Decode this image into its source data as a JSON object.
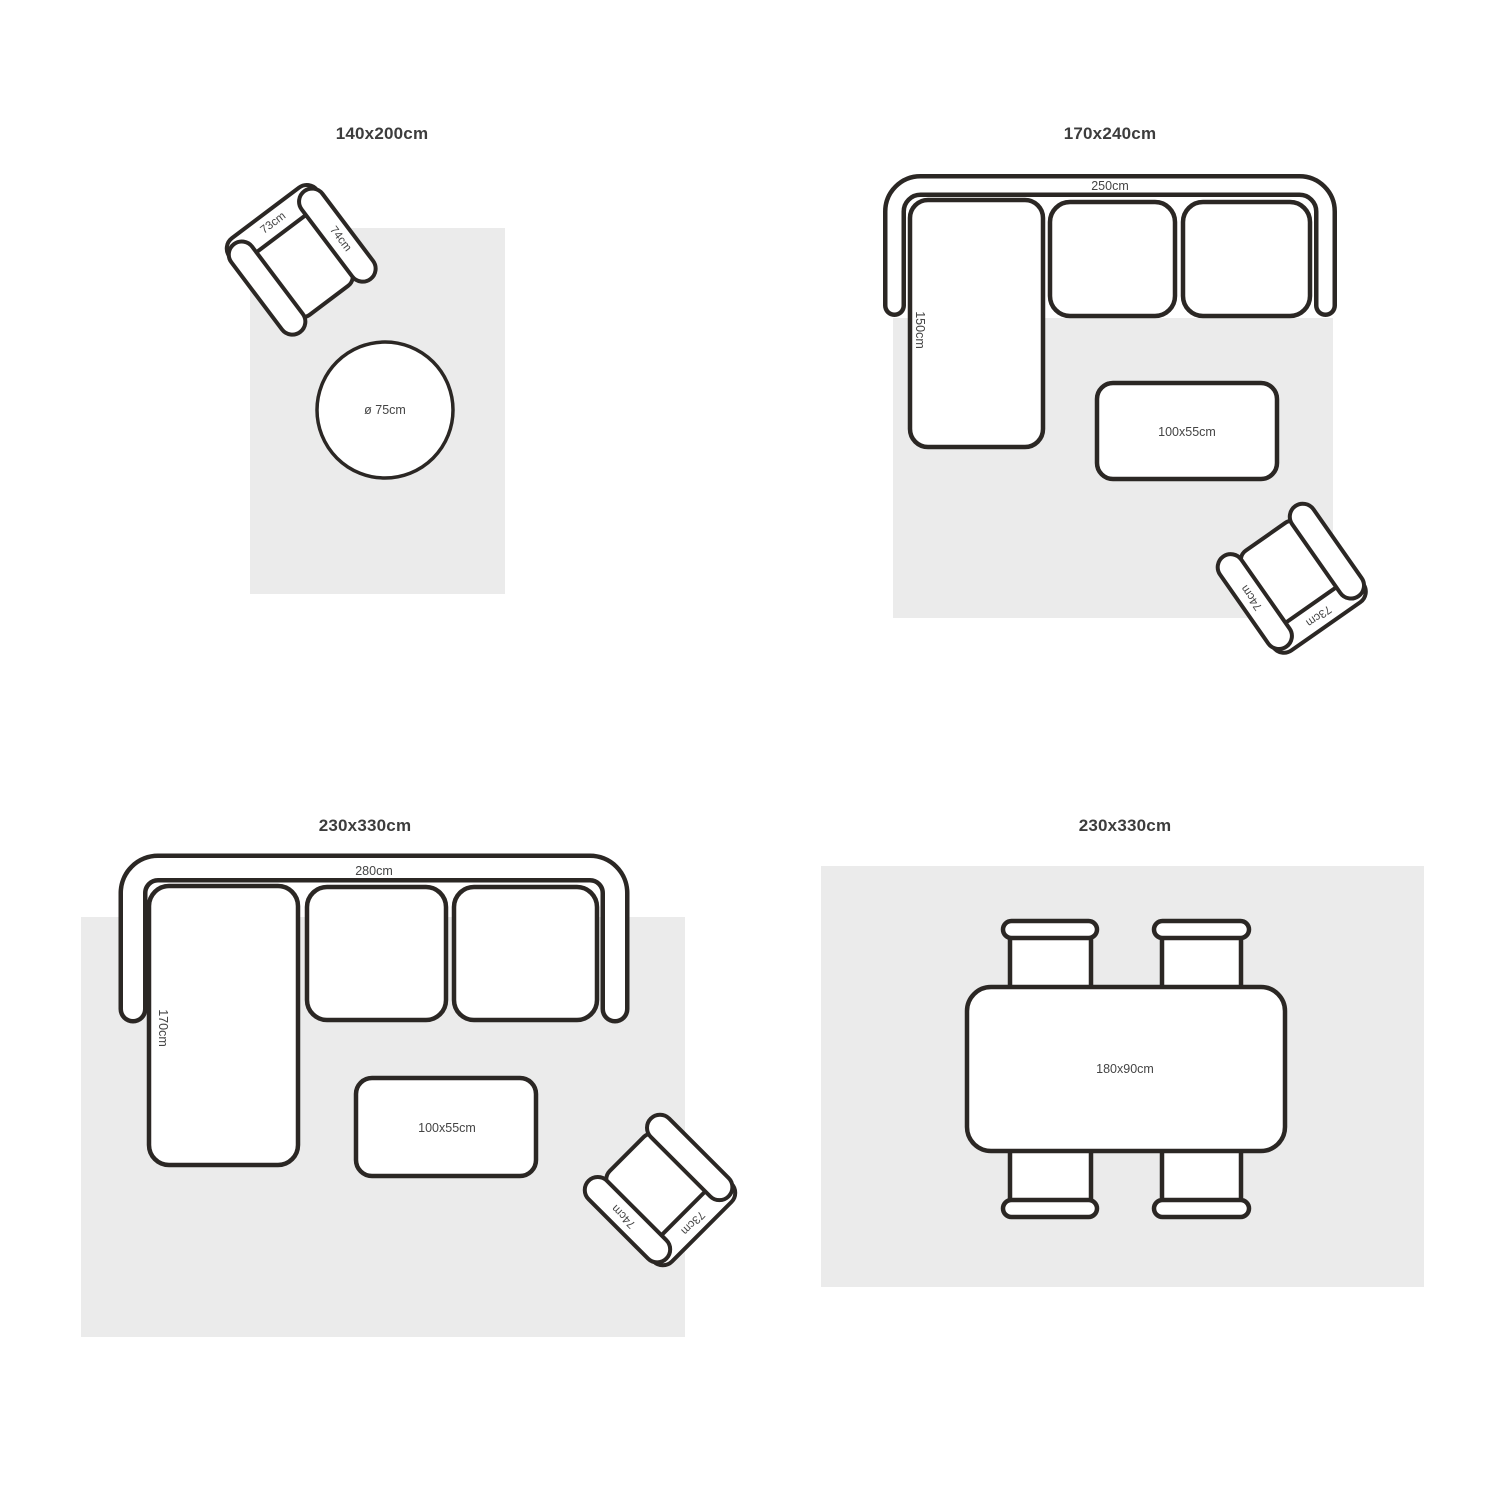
{
  "colors": {
    "outline": "#2b2724",
    "rug": "#ebebeb",
    "furniture_fill": "#ffffff",
    "title_text": "#3d3d3d",
    "label_text": "#444444",
    "background": "#ffffff"
  },
  "quadrants": [
    {
      "id": "rug-140x200",
      "title": "140x200cm",
      "furniture": {
        "armchair": {
          "back_label": "73cm",
          "arm_label": "74cm"
        },
        "round_table": {
          "label": "ø 75cm"
        }
      }
    },
    {
      "id": "rug-170x240",
      "title": "170x240cm",
      "furniture": {
        "sofa": {
          "width_label": "250cm",
          "chaise_label": "150cm"
        },
        "coffee_table": {
          "label": "100x55cm"
        },
        "armchair": {
          "back_label": "73cm",
          "arm_label": "74cm"
        }
      }
    },
    {
      "id": "rug-230x330-living",
      "title": "230x330cm",
      "furniture": {
        "sofa": {
          "width_label": "280cm",
          "chaise_label": "170cm"
        },
        "coffee_table": {
          "label": "100x55cm"
        },
        "armchair": {
          "back_label": "73cm",
          "arm_label": "74cm"
        }
      }
    },
    {
      "id": "rug-230x330-dining",
      "title": "230x330cm",
      "furniture": {
        "dining_table": {
          "label": "180x90cm"
        },
        "chairs_count": 4
      }
    }
  ]
}
